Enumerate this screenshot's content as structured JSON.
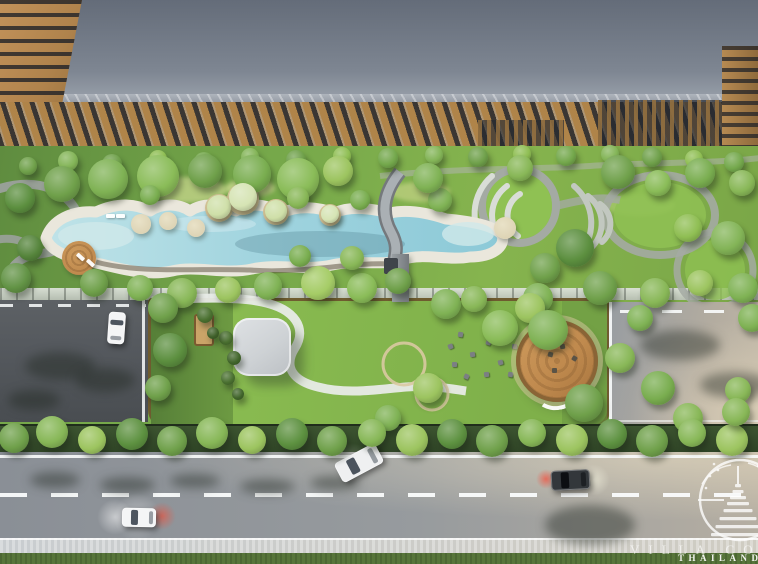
{
  "scene": {
    "type": "aerial-architectural-render",
    "watermark": {
      "brand_line": "VILLA CO",
      "country_line": "THAILAND"
    }
  },
  "colors": {
    "roof_top": "#646c79",
    "roof_bottom": "#9ba2ac",
    "roof_edge": "#aeb4bc",
    "corner_wood": "#b0834c",
    "window_dark": "#23262c",
    "facade_wood": "#a87f47",
    "facade_glass": "#343b45",
    "pergola_wood": "#8a6a3e",
    "garden_dark": "#5f8c3f",
    "garden_mid": "#76a84a",
    "garden_bright": "#86b44e",
    "lawn_bright": "#8fc153",
    "pool_water": "#9fd3de",
    "pool_water_deep": "#86c4d2",
    "pool_shallow": "#cfe9ea",
    "pool_deck": "#eae7dc",
    "path_gray": "#9ba19c",
    "path_ring": "#a4aaa3",
    "path_white": "#e8ebe7",
    "path_tan": "#d9c9a2",
    "platform_wall": "#6b4c2a",
    "platform_lawn": "#8cbe52",
    "canopy": "#ced2d5",
    "cabana": "#caa468",
    "deck_wood": "#c08a4e",
    "deck_wood_dark": "#8a6436",
    "driveway": "#55595e",
    "road": "#8a8f96",
    "road_warm": "#c2b9a8",
    "marking": "#f4f6f6",
    "sidewalk": "#c9cdd0",
    "grass": "#57753a",
    "hedge": "#3c5430",
    "island_tan": "#cbb98f",
    "deck_tan": "#ddd3b4",
    "brake_red": "#ff3a2d",
    "watermark": "#ffffff"
  },
  "landscape": {
    "trees": [
      [
        28,
        166,
        9,
        "#6fa04a"
      ],
      [
        68,
        161,
        10,
        "#83b457"
      ],
      [
        112,
        164,
        10,
        "#6fa04a"
      ],
      [
        158,
        159,
        9,
        "#8fbe53"
      ],
      [
        204,
        162,
        10,
        "#74a84c"
      ],
      [
        250,
        157,
        9,
        "#83b457"
      ],
      [
        296,
        160,
        10,
        "#6fa04a"
      ],
      [
        342,
        156,
        9,
        "#8fbe53"
      ],
      [
        388,
        158,
        10,
        "#74a84c"
      ],
      [
        434,
        155,
        9,
        "#83b457"
      ],
      [
        478,
        157,
        10,
        "#6fa04a"
      ],
      [
        522,
        154,
        9,
        "#8fbe53"
      ],
      [
        566,
        156,
        10,
        "#74a84c"
      ],
      [
        610,
        154,
        9,
        "#83b457"
      ],
      [
        652,
        157,
        10,
        "#6fa04a"
      ],
      [
        694,
        159,
        9,
        "#8fbe53"
      ],
      [
        734,
        162,
        10,
        "#74a84c"
      ],
      [
        20,
        198,
        15,
        "#5c8f3f"
      ],
      [
        62,
        184,
        18,
        "#6fa04a"
      ],
      [
        108,
        179,
        20,
        "#7fb254"
      ],
      [
        158,
        176,
        21,
        "#8abc58"
      ],
      [
        205,
        171,
        17,
        "#6fa04a"
      ],
      [
        252,
        174,
        19,
        "#79ad4f"
      ],
      [
        298,
        179,
        21,
        "#8abc58"
      ],
      [
        338,
        171,
        15,
        "#9cc45f"
      ],
      [
        30,
        248,
        13,
        "#55843b"
      ],
      [
        16,
        278,
        15,
        "#629345"
      ],
      [
        94,
        283,
        14,
        "#6fa04a"
      ],
      [
        140,
        288,
        13,
        "#7fb254"
      ],
      [
        182,
        293,
        15,
        "#88b757"
      ],
      [
        228,
        290,
        13,
        "#9cc45f"
      ],
      [
        268,
        286,
        14,
        "#7fb254"
      ],
      [
        318,
        283,
        17,
        "#a5cc66"
      ],
      [
        362,
        288,
        15,
        "#8abc58"
      ],
      [
        398,
        281,
        13,
        "#6fa04a"
      ],
      [
        352,
        258,
        12,
        "#88b757"
      ],
      [
        300,
        256,
        11,
        "#79ad4f"
      ],
      [
        150,
        195,
        10,
        "#79ad4f"
      ],
      [
        298,
        198,
        11,
        "#88b757"
      ],
      [
        360,
        200,
        10,
        "#79ad4f"
      ],
      [
        440,
        200,
        12,
        "#7fb254"
      ],
      [
        219,
        207,
        12,
        "#cfdfa8"
      ],
      [
        243,
        197,
        14,
        "#d6e4b4"
      ],
      [
        276,
        211,
        11,
        "#cfdfa8"
      ],
      [
        330,
        214,
        9,
        "#d6e4b4"
      ],
      [
        428,
        178,
        15,
        "#7fb254"
      ],
      [
        520,
        168,
        13,
        "#88b757"
      ],
      [
        618,
        172,
        17,
        "#6fa04a"
      ],
      [
        658,
        183,
        13,
        "#8abc58"
      ],
      [
        700,
        173,
        15,
        "#79ad4f"
      ],
      [
        742,
        183,
        13,
        "#88b757"
      ],
      [
        575,
        248,
        19,
        "#5c8f3f"
      ],
      [
        545,
        268,
        15,
        "#6fa04a"
      ],
      [
        538,
        298,
        15,
        "#7fb254"
      ],
      [
        600,
        288,
        17,
        "#6fa04a"
      ],
      [
        655,
        293,
        15,
        "#88b757"
      ],
      [
        700,
        283,
        13,
        "#9cc45f"
      ],
      [
        743,
        288,
        15,
        "#7fb254"
      ],
      [
        728,
        238,
        17,
        "#83b457"
      ],
      [
        688,
        228,
        14,
        "#8fbe53"
      ],
      [
        163,
        308,
        15,
        "#6fa04a"
      ],
      [
        170,
        350,
        17,
        "#5c8f3f"
      ],
      [
        158,
        388,
        13,
        "#6fa04a"
      ],
      [
        446,
        304,
        15,
        "#7fb254"
      ],
      [
        474,
        299,
        13,
        "#88b757"
      ],
      [
        500,
        328,
        18,
        "#8abc58"
      ],
      [
        530,
        308,
        15,
        "#9cc45f"
      ],
      [
        548,
        330,
        20,
        "#7fb254"
      ],
      [
        584,
        403,
        19,
        "#6fa04a"
      ],
      [
        620,
        358,
        15,
        "#88b757"
      ],
      [
        640,
        318,
        13,
        "#7fb254"
      ],
      [
        658,
        388,
        17,
        "#79ad4f"
      ],
      [
        688,
        418,
        15,
        "#88b757"
      ],
      [
        428,
        388,
        15,
        "#9cc45f"
      ],
      [
        388,
        418,
        13,
        "#7fb254"
      ],
      [
        226,
        338,
        7,
        "#4a7030"
      ],
      [
        234,
        358,
        7,
        "#41652b"
      ],
      [
        228,
        378,
        7,
        "#4a7030"
      ],
      [
        238,
        394,
        6,
        "#41652b"
      ],
      [
        205,
        315,
        8,
        "#4a7030"
      ],
      [
        213,
        333,
        6,
        "#3f6029"
      ],
      [
        14,
        438,
        15,
        "#6fa04a"
      ],
      [
        52,
        432,
        16,
        "#87b757"
      ],
      [
        92,
        440,
        14,
        "#9cc45f"
      ],
      [
        132,
        434,
        16,
        "#5d9140"
      ],
      [
        172,
        441,
        15,
        "#6fa04a"
      ],
      [
        212,
        433,
        16,
        "#87b757"
      ],
      [
        252,
        440,
        14,
        "#9cc45f"
      ],
      [
        292,
        434,
        16,
        "#5d9140"
      ],
      [
        332,
        441,
        15,
        "#6fa04a"
      ],
      [
        372,
        433,
        14,
        "#87b757"
      ],
      [
        412,
        440,
        16,
        "#9cc45f"
      ],
      [
        452,
        434,
        15,
        "#5d9140"
      ],
      [
        492,
        441,
        16,
        "#6fa04a"
      ],
      [
        532,
        433,
        14,
        "#87b757"
      ],
      [
        572,
        440,
        16,
        "#9cc45f"
      ],
      [
        612,
        434,
        15,
        "#5d9140"
      ],
      [
        652,
        441,
        16,
        "#6fa04a"
      ],
      [
        692,
        433,
        14,
        "#87b757"
      ],
      [
        732,
        440,
        16,
        "#9cc45f"
      ],
      [
        752,
        318,
        14,
        "#7fb254"
      ],
      [
        738,
        390,
        13,
        "#88b757"
      ],
      [
        736,
        412,
        14,
        "#88b757"
      ]
    ],
    "pool_islands": [
      [
        219,
        208,
        14
      ],
      [
        243,
        199,
        16
      ],
      [
        276,
        212,
        13
      ],
      [
        330,
        215,
        11
      ]
    ],
    "pool_decks": [
      [
        141,
        224,
        10
      ],
      [
        168,
        221,
        9
      ],
      [
        196,
        228,
        9
      ],
      [
        505,
        228,
        11
      ]
    ],
    "wood_deck": [
      79,
      258,
      17
    ],
    "loungers": [
      [
        106,
        214,
        0
      ],
      [
        116,
        214,
        0
      ],
      [
        76,
        255,
        42
      ],
      [
        86,
        261,
        42
      ]
    ],
    "ground_patches": [
      [
        185,
        190,
        84,
        26,
        "#c3d489"
      ],
      [
        420,
        192,
        60,
        20,
        "#bccf7f"
      ],
      [
        148,
        240,
        40,
        16,
        "#c8d78e"
      ],
      [
        640,
        205,
        70,
        22,
        "#a5c96a"
      ],
      [
        250,
        188,
        50,
        18,
        "#cbd98f"
      ]
    ],
    "lawn_seats": [
      [
        458,
        332,
        10
      ],
      [
        470,
        352,
        -8
      ],
      [
        486,
        340,
        20
      ],
      [
        452,
        362,
        0
      ],
      [
        498,
        360,
        -15
      ],
      [
        512,
        344,
        8
      ],
      [
        464,
        374,
        25
      ],
      [
        484,
        372,
        -5
      ],
      [
        508,
        372,
        12
      ],
      [
        448,
        344,
        -20
      ]
    ],
    "deck_seats": [
      [
        548,
        352,
        15
      ],
      [
        560,
        344,
        -10
      ],
      [
        572,
        356,
        30
      ],
      [
        552,
        368,
        0
      ]
    ]
  },
  "traffic": {
    "vehicles": [
      [
        108,
        312,
        17,
        32,
        4,
        "#f4f5f6"
      ],
      [
        122,
        508,
        34,
        19,
        1,
        "#f4f5f6"
      ],
      [
        336,
        452,
        46,
        22,
        -28,
        "#eff0f1"
      ],
      [
        551,
        470,
        39,
        20,
        -3,
        "#33373b"
      ]
    ],
    "glows": [
      [
        162,
        516,
        14,
        "rgba(255,70,45,0.55)"
      ],
      [
        115,
        517,
        18,
        "rgba(255,255,255,0.5)"
      ],
      [
        546,
        479,
        10,
        "rgba(255,60,40,0.6)"
      ],
      [
        594,
        480,
        16,
        "rgba(255,255,235,0.5)"
      ],
      [
        352,
        463,
        20,
        "rgba(255,255,255,0.3)"
      ],
      [
        137,
        517,
        24,
        "rgba(255,255,255,0.35)"
      ]
    ],
    "shadows": [
      [
        25,
        352,
        70,
        28
      ],
      [
        75,
        368,
        60,
        24
      ],
      [
        8,
        390,
        52,
        20
      ],
      [
        545,
        505,
        90,
        40
      ],
      [
        640,
        330,
        80,
        30
      ],
      [
        700,
        372,
        70,
        26
      ],
      [
        30,
        472,
        50,
        16
      ],
      [
        100,
        477,
        55,
        16
      ],
      [
        170,
        474,
        50,
        14
      ],
      [
        240,
        479,
        55,
        15
      ],
      [
        310,
        476,
        50,
        14
      ]
    ]
  }
}
